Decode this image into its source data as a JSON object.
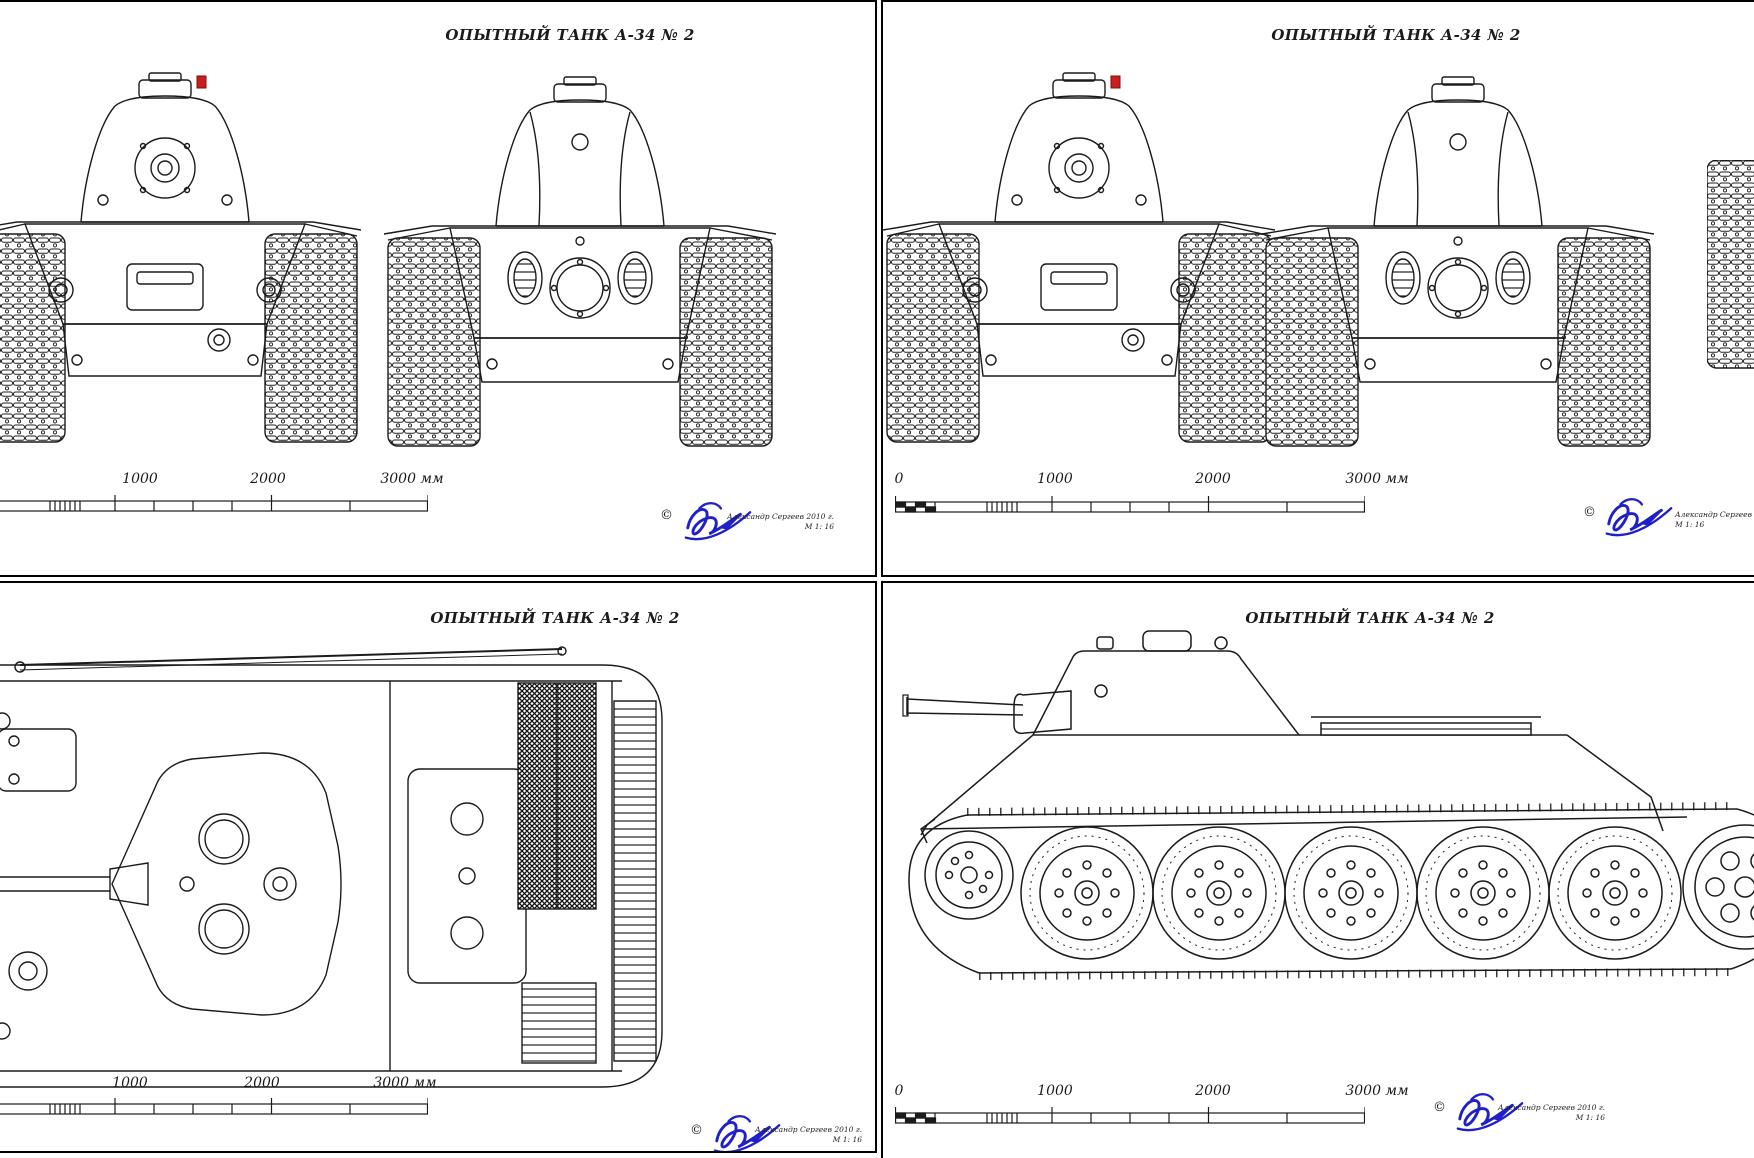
{
  "colors": {
    "paper": "#ffffff",
    "ink": "#1b1b1b",
    "signature_blue": "#2020c8",
    "lamp_red": "#c81e1e"
  },
  "panels": {
    "top_left": {
      "title": "ОПЫТНЫЙ ТАНК А-34 № 2",
      "scale_labels": [
        "1000",
        "2000",
        "3000 мм"
      ],
      "credit": {
        "copyright": "©",
        "author": "Александр Сергеев 2010 г.",
        "scale_note": "М 1: 16"
      }
    },
    "top_right": {
      "title": "ОПЫТНЫЙ ТАНК А-34 № 2",
      "scale_labels": [
        "0",
        "1000",
        "2000",
        "3000 мм"
      ],
      "credit": {
        "copyright": "©",
        "author": "Александр Сергеев 2010 г.",
        "scale_note": "М 1: 16"
      }
    },
    "bottom_left": {
      "title": "ОПЫТНЫЙ ТАНК А-34 № 2",
      "scale_labels": [
        "1000",
        "2000",
        "3000 мм"
      ],
      "credit": {
        "copyright": "©",
        "author": "Александр Сергеев 2010 г.",
        "scale_note": "М 1: 16"
      }
    },
    "bottom_right": {
      "title": "ОПЫТНЫЙ ТАНК А-34 № 2",
      "scale_labels": [
        "0",
        "1000",
        "2000",
        "3000 мм"
      ],
      "credit": {
        "copyright": "©",
        "author": "Александр Сергеев 2010 г.",
        "scale_note": "М 1: 16"
      }
    }
  }
}
